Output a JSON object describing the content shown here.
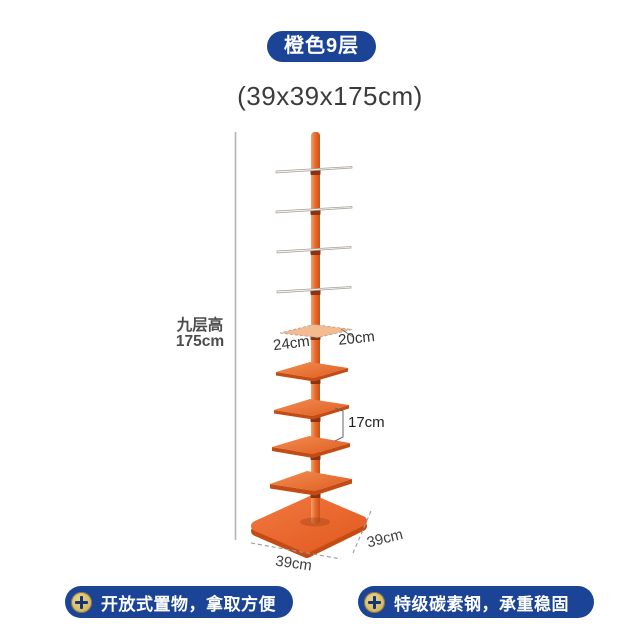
{
  "badge": {
    "label": "橙色9层"
  },
  "size_title": "(39x39x175cm)",
  "diagram": {
    "tiers": 9,
    "height_label_line1": "九层高",
    "height_label_line2": "175cm",
    "shelf_width_label": "24cm",
    "shelf_depth_label": "20cm",
    "tier_gap_label": "17cm",
    "base_width_label": "39cm",
    "base_depth_label": "39cm"
  },
  "features": [
    {
      "icon": "plus-icon",
      "text": "开放式置物，拿取方便"
    },
    {
      "icon": "plus-icon",
      "text": "特级碳素钢，承重稳固"
    }
  ],
  "colors": {
    "banner_blue": "#1c4496",
    "accent_orange": "#e8622d",
    "badge_gold": "#d9bf72",
    "dimension_gray": "#9b9b9b"
  }
}
